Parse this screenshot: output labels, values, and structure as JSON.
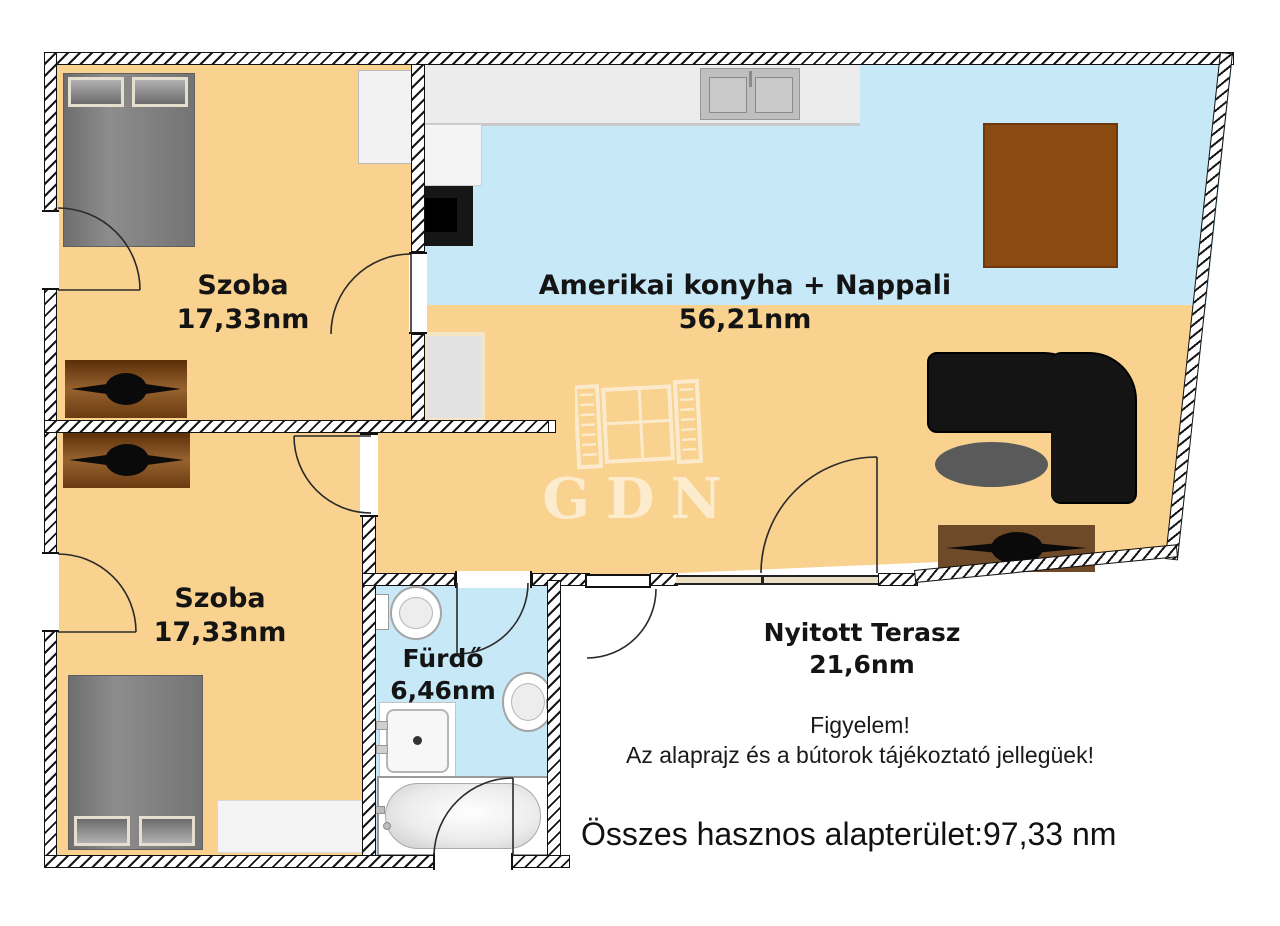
{
  "watermark": {
    "text": "GDN"
  },
  "rooms": {
    "bedroom1": {
      "name": "Szoba",
      "area": "17,33nm"
    },
    "bedroom2": {
      "name": "Szoba",
      "area": "17,33nm"
    },
    "living": {
      "name": "Amerikai konyha + Nappali",
      "area": "56,21nm"
    },
    "bathroom": {
      "name": "Fürdő",
      "area": "6,46nm"
    },
    "terrace": {
      "name": "Nyitott Terasz",
      "area": "21,6nm"
    }
  },
  "notes": {
    "warning_title": "Figyelem!",
    "warning_body": "Az alaprajz és a bútorok tájékoztató jellegüek!"
  },
  "summary": {
    "total_area_line": "Összes hasznos alapterület:97,33 nm"
  },
  "colors": {
    "floor_room": "#F8D28E",
    "floor_wet": "#C6E8F7",
    "furniture_wood": "#8B4A12",
    "furniture_wood_dark": "#5E2F06",
    "sofa_black": "#141414"
  }
}
